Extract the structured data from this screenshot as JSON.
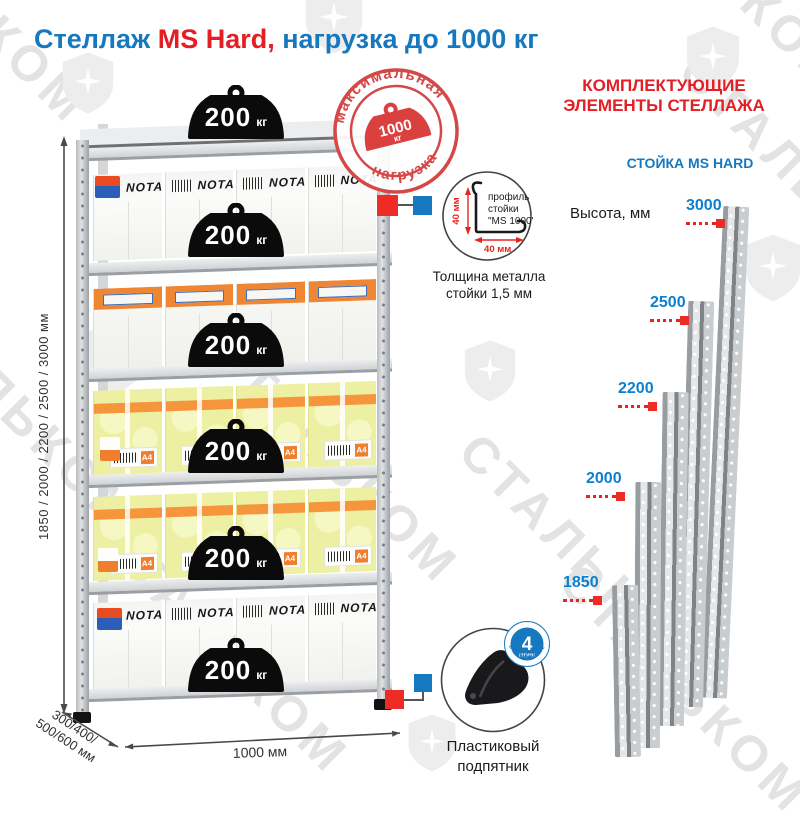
{
  "title": {
    "part1": "Стеллаж ",
    "part2": "MS Hard,",
    "part3": " нагрузка до 1000 кг"
  },
  "stamp": {
    "arc_top": "максимальная",
    "arc_bottom": "нагрузка",
    "value": "1000",
    "unit": "кг"
  },
  "weights": {
    "value": "200",
    "unit": "кг"
  },
  "boxes": {
    "nota": "NOTA",
    "a4": "A4"
  },
  "dimensions": {
    "heights_side": "1850 / 2000 / 2200 / 2500 / 3000 мм",
    "depth_line1": "300/400/",
    "depth_line2": "500/600 мм",
    "width": "1000 мм"
  },
  "components": {
    "header_line1": "КОМПЛЕКТУЮЩИЕ",
    "header_line2": "ЭЛЕМЕНТЫ СТЕЛЛАЖА",
    "stand_title": "СТОЙКА MS HARD",
    "height_label": "Высота, мм",
    "heights": [
      {
        "label": "3000"
      },
      {
        "label": "2500"
      },
      {
        "label": "2200"
      },
      {
        "label": "2000"
      },
      {
        "label": "1850"
      }
    ],
    "profile": {
      "line1": "профиль",
      "line2": "стойки",
      "line3": "\"MS 1000\"",
      "dim_vertical": "40 мм",
      "dim_horizontal": "40 мм.",
      "thickness_line1": "Толщина металла",
      "thickness_line2": "стойки 1,5 мм"
    },
    "pedestal": {
      "badge_number": "4",
      "badge_word": "штуки",
      "badge_arc": "в комплекте",
      "caption_line1": "Пластиковый",
      "caption_line2": "подпятник"
    }
  },
  "watermark": {
    "text": "СТАЛЬКОМ"
  },
  "colors": {
    "blue": "#1679c0",
    "red": "#e31e24",
    "stamp_red": "#d64848",
    "marker_red": "#ee2b25"
  }
}
